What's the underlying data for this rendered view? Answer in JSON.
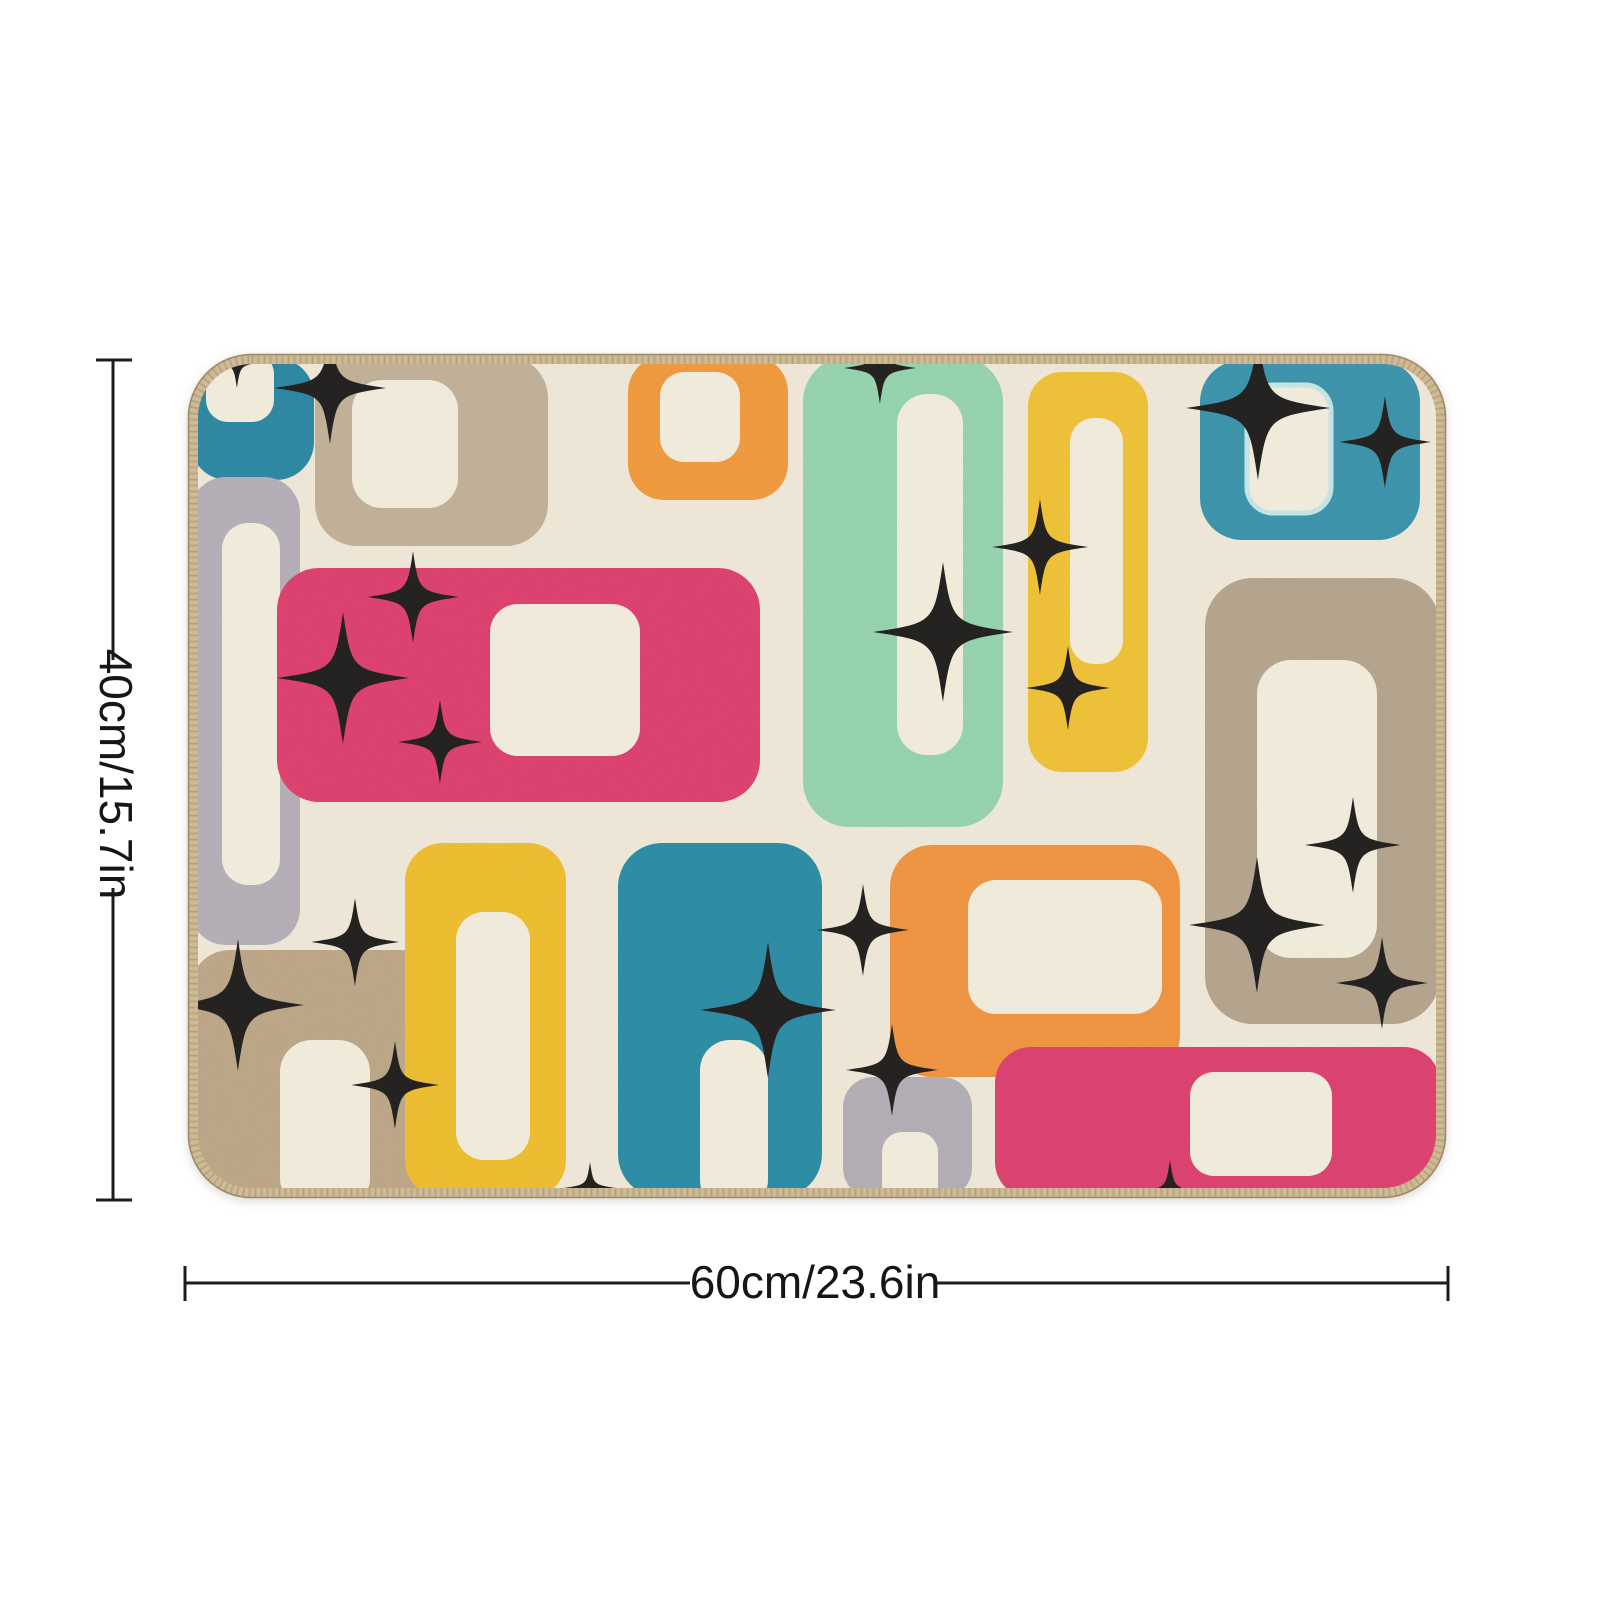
{
  "page": {
    "background": "#ffffff"
  },
  "annotations": {
    "line_color": "#1c1c1c",
    "vertical_label": "40cm/15.7in",
    "horizontal_label": "60cm/23.6in"
  },
  "rug": {
    "background_color": "#efe8d8",
    "inner_cutout_color": "#f2ecdc",
    "star_color": "#211f1d",
    "edge": {
      "stitch_color": "#cfba96",
      "stitch_dash_color": "#a8946f",
      "edge_line_color": "#9e8a67"
    },
    "palette": {
      "teal": "#2c87a2",
      "teal_light": "#3b93ab",
      "mint": "#95d3ad",
      "yellow": "#efc136",
      "orange": "#f0993c",
      "pink": "#dd3f6e",
      "tan": "#bca687",
      "gray": "#b5aeb6",
      "halo_blue": "#c5e6e6"
    },
    "shapes": [
      {
        "name": "teal-rect-top-left",
        "fill": "#2c87a2",
        "x": 190,
        "y": 358,
        "w": 124,
        "h": 122,
        "r": 38,
        "inner": {
          "x": 206,
          "y": 352,
          "w": 68,
          "h": 70,
          "r": 22
        }
      },
      {
        "name": "tan-rect-top",
        "fill": "#c2b098",
        "x": 315,
        "y": 356,
        "w": 233,
        "h": 190,
        "r": 42,
        "inner": {
          "x": 352,
          "y": 380,
          "w": 106,
          "h": 128,
          "r": 30
        }
      },
      {
        "name": "orange-rect-top",
        "fill": "#f0993c",
        "x": 628,
        "y": 356,
        "w": 160,
        "h": 144,
        "r": 36,
        "inner": {
          "x": 660,
          "y": 372,
          "w": 80,
          "h": 90,
          "r": 24
        }
      },
      {
        "name": "mint-rect-top",
        "fill": "#95d3ad",
        "x": 803,
        "y": 356,
        "w": 200,
        "h": 471,
        "r": 46,
        "inner": {
          "x": 897,
          "y": 394,
          "w": 66,
          "h": 361,
          "r": 30
        }
      },
      {
        "name": "yellow-rect-top",
        "fill": "#efc136",
        "x": 1028,
        "y": 372,
        "w": 120,
        "h": 400,
        "r": 34,
        "inner": {
          "x": 1070,
          "y": 418,
          "w": 53,
          "h": 246,
          "r": 24
        }
      },
      {
        "name": "teal-square-top-right",
        "fill": "#3b93ab",
        "x": 1200,
        "y": 360,
        "w": 220,
        "h": 180,
        "r": 42,
        "inner": {
          "x": 1247,
          "y": 385,
          "w": 84,
          "h": 128,
          "r": 26,
          "halo": "#c5e6e6"
        }
      },
      {
        "name": "tan-rect-right",
        "fill": "#b4a48d",
        "x": 1205,
        "y": 578,
        "w": 235,
        "h": 446,
        "r": 48,
        "inner": {
          "x": 1257,
          "y": 660,
          "w": 120,
          "h": 298,
          "r": 34
        }
      },
      {
        "name": "gray-rect-left",
        "fill": "#b5aeb6",
        "x": 190,
        "y": 477,
        "w": 110,
        "h": 468,
        "r": 36,
        "inner": {
          "x": 222,
          "y": 523,
          "w": 58,
          "h": 362,
          "r": 26
        }
      },
      {
        "name": "pink-rect-middle",
        "fill": "#dd3f6e",
        "x": 277,
        "y": 568,
        "w": 483,
        "h": 234,
        "r": 42,
        "inner": {
          "x": 490,
          "y": 604,
          "w": 150,
          "h": 152,
          "r": 28
        }
      },
      {
        "name": "tan-rect-bottom-left",
        "fill": "#bca687",
        "x": 190,
        "y": 950,
        "w": 250,
        "h": 248,
        "r": 40,
        "inner": {
          "x": 280,
          "y": 1040,
          "w": 90,
          "h": 170,
          "r": 32
        }
      },
      {
        "name": "yellow-rect-bottom",
        "fill": "#eebd2e",
        "x": 405,
        "y": 843,
        "w": 161,
        "h": 355,
        "r": 38,
        "inner": {
          "x": 456,
          "y": 912,
          "w": 74,
          "h": 248,
          "r": 28
        }
      },
      {
        "name": "teal-rect-bottom",
        "fill": "#2b8ba4",
        "x": 618,
        "y": 843,
        "w": 204,
        "h": 355,
        "r": 44,
        "inner": {
          "x": 700,
          "y": 1040,
          "w": 68,
          "h": 170,
          "r": 30
        }
      },
      {
        "name": "orange-rect-bottom",
        "fill": "#ef9440",
        "x": 890,
        "y": 845,
        "w": 290,
        "h": 232,
        "r": 42,
        "inner": {
          "x": 968,
          "y": 880,
          "w": 194,
          "h": 134,
          "r": 28
        }
      },
      {
        "name": "gray-rect-bottom",
        "fill": "#b3adb5",
        "x": 843,
        "y": 1077,
        "w": 129,
        "h": 121,
        "r": 30,
        "inner": {
          "x": 882,
          "y": 1132,
          "w": 56,
          "h": 78,
          "r": 20
        }
      },
      {
        "name": "pink-rect-bottom-right",
        "fill": "#dc406f",
        "x": 995,
        "y": 1047,
        "w": 445,
        "h": 151,
        "r": 36,
        "inner": {
          "x": 1190,
          "y": 1072,
          "w": 142,
          "h": 104,
          "r": 24
        }
      }
    ],
    "stars": [
      [
        330,
        388,
        56
      ],
      [
        237,
        362,
        26
      ],
      [
        880,
        368,
        36
      ],
      [
        1258,
        408,
        72
      ],
      [
        1385,
        442,
        46
      ],
      [
        943,
        632,
        70
      ],
      [
        1040,
        547,
        48
      ],
      [
        1068,
        688,
        42
      ],
      [
        413,
        597,
        46
      ],
      [
        343,
        678,
        66
      ],
      [
        440,
        742,
        42
      ],
      [
        238,
        1005,
        66
      ],
      [
        355,
        942,
        44
      ],
      [
        395,
        1085,
        44
      ],
      [
        768,
        1010,
        68
      ],
      [
        863,
        930,
        46
      ],
      [
        892,
        1070,
        46
      ],
      [
        1353,
        845,
        48
      ],
      [
        1257,
        925,
        68
      ],
      [
        1382,
        983,
        46
      ],
      [
        1170,
        1192,
        32
      ],
      [
        590,
        1188,
        26
      ]
    ]
  }
}
